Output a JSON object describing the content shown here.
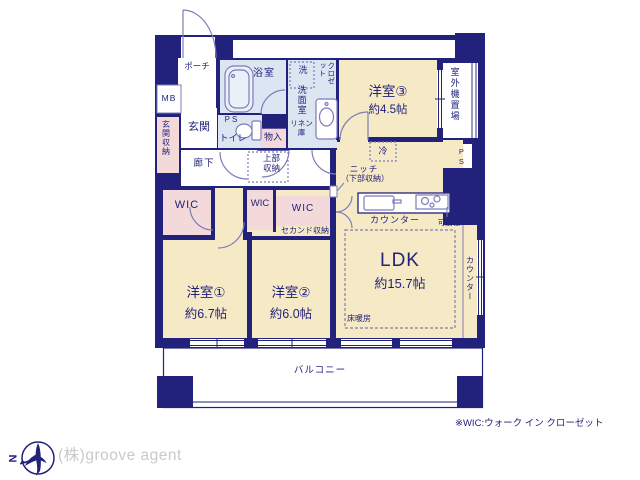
{
  "colors": {
    "wall": "#22227d",
    "line": "#7d7db8",
    "room_cream": "#f6e9c6",
    "storage_pink": "#f3d9d9",
    "wet_blue": "#dbe6f2",
    "logo_gray": "#c9c9c9"
  },
  "rooms": {
    "porch": "ポーチ",
    "mb": "MB",
    "entrance": "玄関",
    "entrance_storage": "玄関収納",
    "hallway": "廊下",
    "bath": "浴室",
    "ps_toilet": "PS",
    "toilet": "トイレ",
    "storage": "物入",
    "washer": "洗",
    "washroom": "洗面室",
    "linen": "リネン庫",
    "closet": "クロゼット",
    "upper_storage": "上部収納",
    "bedroom3_name": "洋室③",
    "bedroom3_size": "約4.5帖",
    "outdoor_unit": "室外機置場",
    "ps_right": "PS",
    "fridge": "冷",
    "niche": "ニッチ",
    "niche_sub": "（下部収納）",
    "kitchen_counter": "カウンター",
    "movable_shelf": "可動棚",
    "ldk_name": "LDK",
    "ldk_size": "約15.7帖",
    "floor_heating": "床暖房",
    "side_counter": "カウンター",
    "wic1": "WIC",
    "wic2": "WIC",
    "wic3": "WIC",
    "second_storage": "セカンド収納",
    "bedroom1_name": "洋室①",
    "bedroom1_size": "約6.7帖",
    "bedroom2_name": "洋室②",
    "bedroom2_size": "約6.0帖",
    "balcony": "バルコニー"
  },
  "compass": {
    "letter": "N"
  },
  "footnote": "※WIC:ウォーク イン クローゼット",
  "company": "(株)groove agent"
}
